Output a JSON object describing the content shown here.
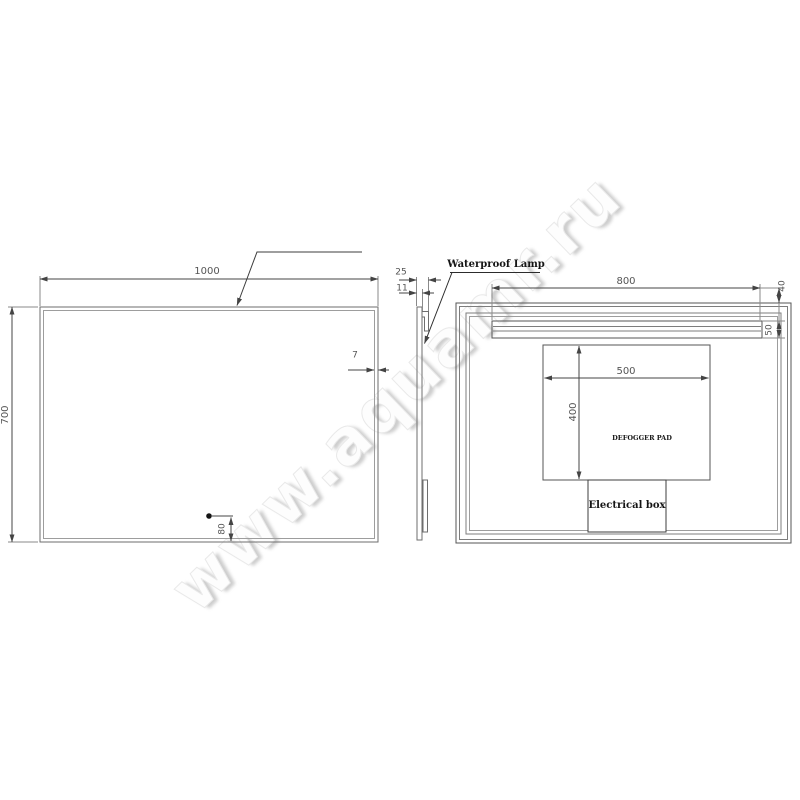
{
  "watermark": "www.aquamr.ru",
  "front_view": {
    "width": "1000",
    "height": "700",
    "frame_thickness": "7",
    "sensor_offset": "80"
  },
  "side_view": {
    "total_depth": "25",
    "panel_thickness": "11"
  },
  "back_view": {
    "lamp_label": "Waterproof Lamp",
    "lamp_length": "800",
    "lamp_top_gap": "40",
    "lamp_height": "50",
    "pad_width": "500",
    "pad_height": "400",
    "pad_label": "DEFOGGER PAD",
    "electrical_box_label": "Electrical box"
  },
  "colors": {
    "line": "#6e6e6e",
    "dim_line": "#444444",
    "dim_text": "#555555",
    "label_text": "#151515"
  }
}
